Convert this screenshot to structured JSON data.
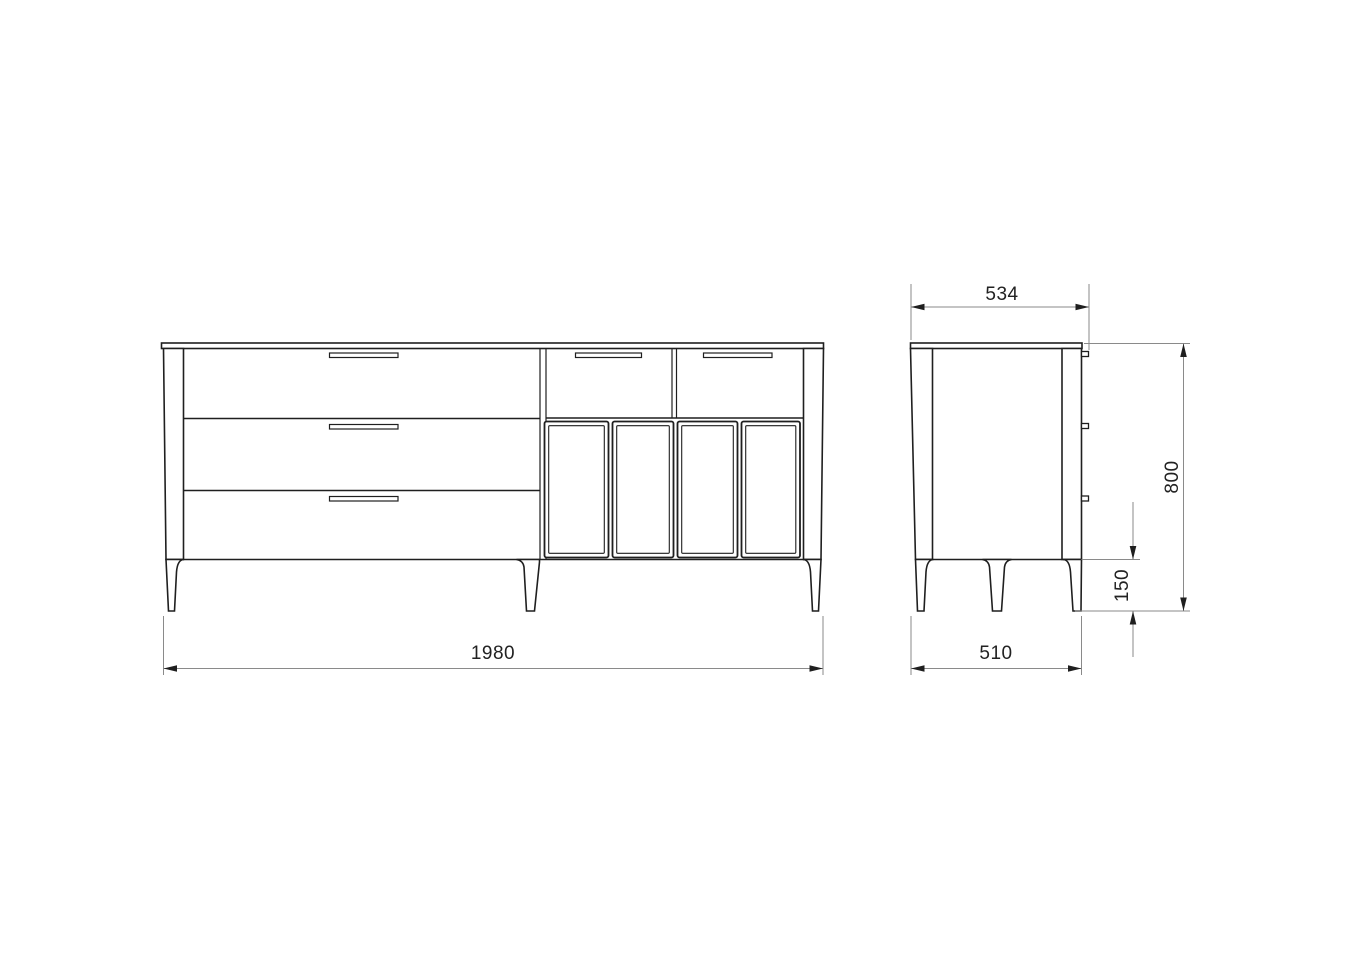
{
  "colors": {
    "background": "#ffffff",
    "outline": "#1f1f1f",
    "dimension_lines": "#8a8a8a",
    "dimension_text": "#222222"
  },
  "front_view": {
    "overall_width_mm": "1980",
    "large_drawer_count": 3,
    "small_drawer_count": 2,
    "door_count": 4,
    "visible_leg_count": 3
  },
  "side_view": {
    "overall_depth_mm": "534",
    "overall_height_mm": "800",
    "leg_height_mm": "150",
    "body_depth_mm": "510",
    "drawer_front_edge_count": 3,
    "visible_leg_count": 3
  }
}
